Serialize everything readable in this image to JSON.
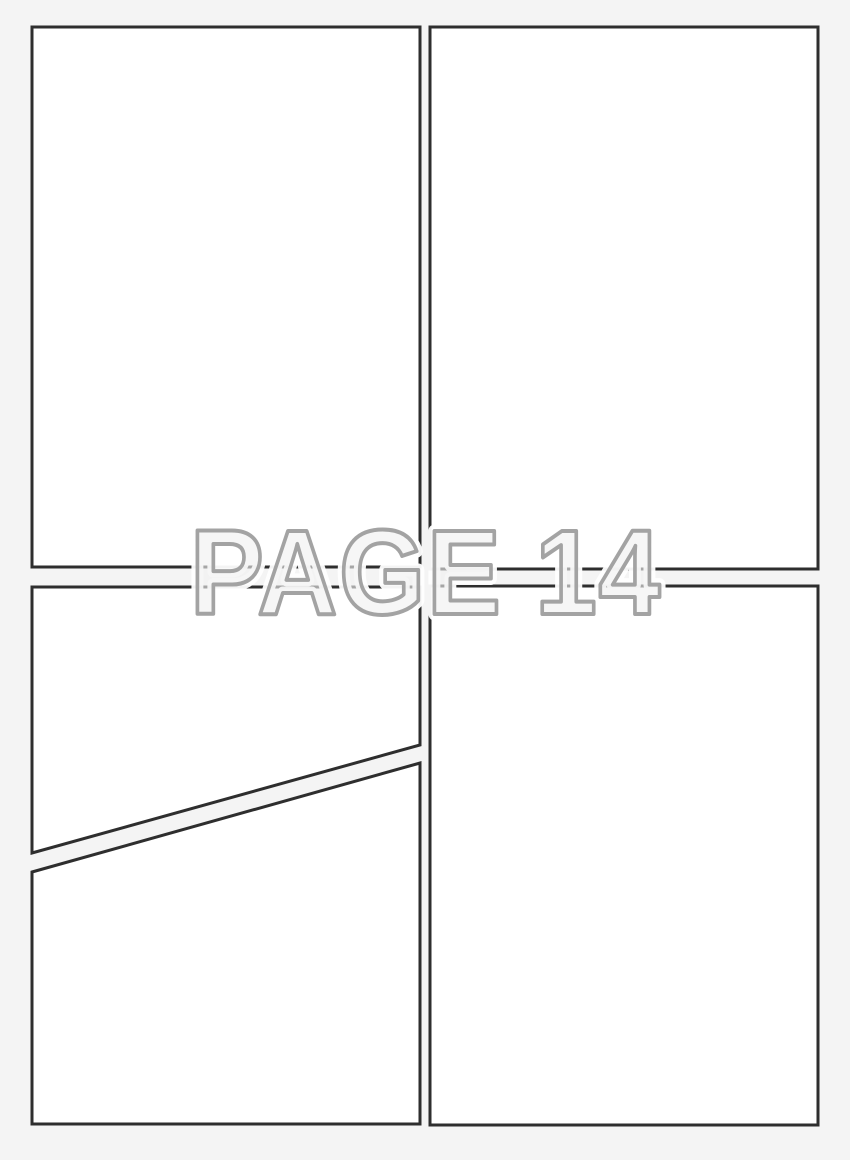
{
  "watermark": {
    "label": "PAGE 14"
  },
  "panels": {
    "count": 5,
    "names": [
      "top-left",
      "top-right",
      "bottom-left-upper",
      "bottom-left-lower",
      "bottom-right"
    ]
  },
  "colors": {
    "background": "#f4f4f4",
    "panel_fill": "#ffffff",
    "panel_border": "#2e2e2e",
    "watermark_fill": "#f1f1f1",
    "watermark_stroke": "#a3a3a3",
    "watermark_halo": "#ffffff"
  }
}
